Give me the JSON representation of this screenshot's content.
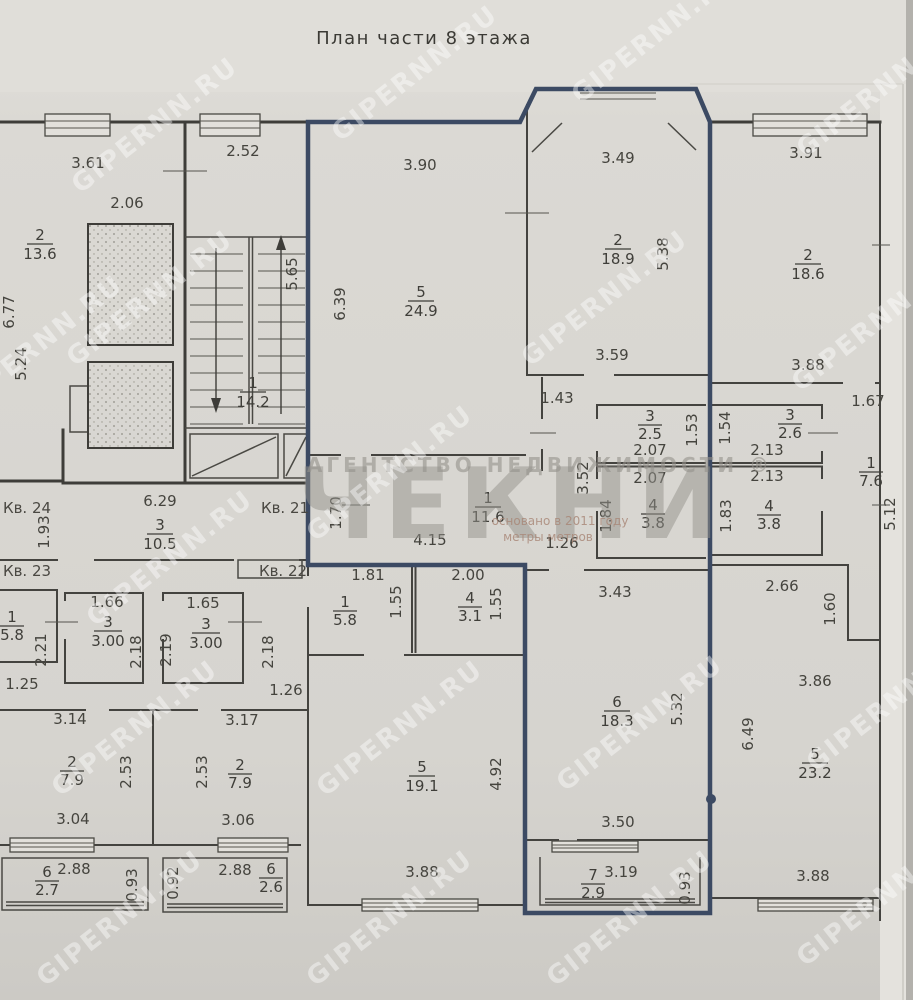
{
  "title": "План части 8 этажа",
  "watermarks": {
    "brand": "GIPERNN.RU",
    "agency_top": "АГЕНТСТВО НЕДВИЖИМОСТИ ®",
    "agency_name": "ЧЕКНИ",
    "agency_sub1": "основано в 2011 году",
    "agency_sub2": "метры метров"
  },
  "colors": {
    "unit_outline": "#3c4a63",
    "paper": "#d8d6d1",
    "line": "#3e3d39"
  },
  "flats": [
    {
      "t": "Кв. 24"
    },
    {
      "t": "Кв. 21"
    },
    {
      "t": "Кв. 23"
    },
    {
      "t": "Кв. 22"
    }
  ],
  "rooms": [
    {
      "n": "2",
      "a": "13.6"
    },
    {
      "n": "1",
      "a": "14.2"
    },
    {
      "n": "5",
      "a": "24.9"
    },
    {
      "n": "2",
      "a": "18.9"
    },
    {
      "n": "2",
      "a": "18.6"
    },
    {
      "n": "3",
      "a": "2.5"
    },
    {
      "n": "3",
      "a": "2.6"
    },
    {
      "n": "4",
      "a": "3.8"
    },
    {
      "n": "4",
      "a": "3.8"
    },
    {
      "n": "1",
      "a": "7.6"
    },
    {
      "n": "3",
      "a": "10.5"
    },
    {
      "n": "1",
      "a": "11.6"
    },
    {
      "n": "1",
      "a": "5.8"
    },
    {
      "n": "3",
      "a": "3.00"
    },
    {
      "n": "3",
      "a": "3.00"
    },
    {
      "n": "1",
      "a": "5.8"
    },
    {
      "n": "4",
      "a": "3.1"
    },
    {
      "n": "6",
      "a": "18.3"
    },
    {
      "n": "5",
      "a": "19.1"
    },
    {
      "n": "2",
      "a": "7.9"
    },
    {
      "n": "2",
      "a": "7.9"
    },
    {
      "n": "5",
      "a": "23.2"
    },
    {
      "n": "7",
      "a": "2.9"
    },
    {
      "n": "6",
      "a": "2.7"
    },
    {
      "n": "6",
      "a": "2.6"
    }
  ],
  "dims": [
    {
      "t": "3.61"
    },
    {
      "t": "2.52"
    },
    {
      "t": "3.90"
    },
    {
      "t": "3.49"
    },
    {
      "t": "3.91"
    },
    {
      "t": "2.06"
    },
    {
      "t": "6.77"
    },
    {
      "t": "5.24"
    },
    {
      "t": "5.65"
    },
    {
      "t": "6.39"
    },
    {
      "t": "5.38"
    },
    {
      "t": "3.59"
    },
    {
      "t": "3.88"
    },
    {
      "t": "1.43"
    },
    {
      "t": "1.67"
    },
    {
      "t": "1.53"
    },
    {
      "t": "1.54"
    },
    {
      "t": "2.07"
    },
    {
      "t": "2.13"
    },
    {
      "t": "2.07"
    },
    {
      "t": "2.13"
    },
    {
      "t": "3.52"
    },
    {
      "t": "1.84"
    },
    {
      "t": "1.83"
    },
    {
      "t": "6.29"
    },
    {
      "t": "1.93"
    },
    {
      "t": "1.70"
    },
    {
      "t": "4.15"
    },
    {
      "t": "1.26"
    },
    {
      "t": "5.12"
    },
    {
      "t": "1.81"
    },
    {
      "t": "2.00"
    },
    {
      "t": "1.55"
    },
    {
      "t": "1.55"
    },
    {
      "t": "3.43"
    },
    {
      "t": "2.66"
    },
    {
      "t": "1.60"
    },
    {
      "t": "1.66"
    },
    {
      "t": "1.65"
    },
    {
      "t": "2.21"
    },
    {
      "t": "2.19"
    },
    {
      "t": "2.18"
    },
    {
      "t": "2.18"
    },
    {
      "t": "1.25"
    },
    {
      "t": "1.26"
    },
    {
      "t": "3.14"
    },
    {
      "t": "3.17"
    },
    {
      "t": "2.53"
    },
    {
      "t": "2.53"
    },
    {
      "t": "6.49"
    },
    {
      "t": "3.86"
    },
    {
      "t": "5.32"
    },
    {
      "t": "4.92"
    },
    {
      "t": "3.50"
    },
    {
      "t": "3.04"
    },
    {
      "t": "3.06"
    },
    {
      "t": "2.88"
    },
    {
      "t": "0.93"
    },
    {
      "t": "0.92"
    },
    {
      "t": "2.88"
    },
    {
      "t": "3.88"
    },
    {
      "t": "3.19"
    },
    {
      "t": "0.93"
    },
    {
      "t": "3.88"
    }
  ]
}
